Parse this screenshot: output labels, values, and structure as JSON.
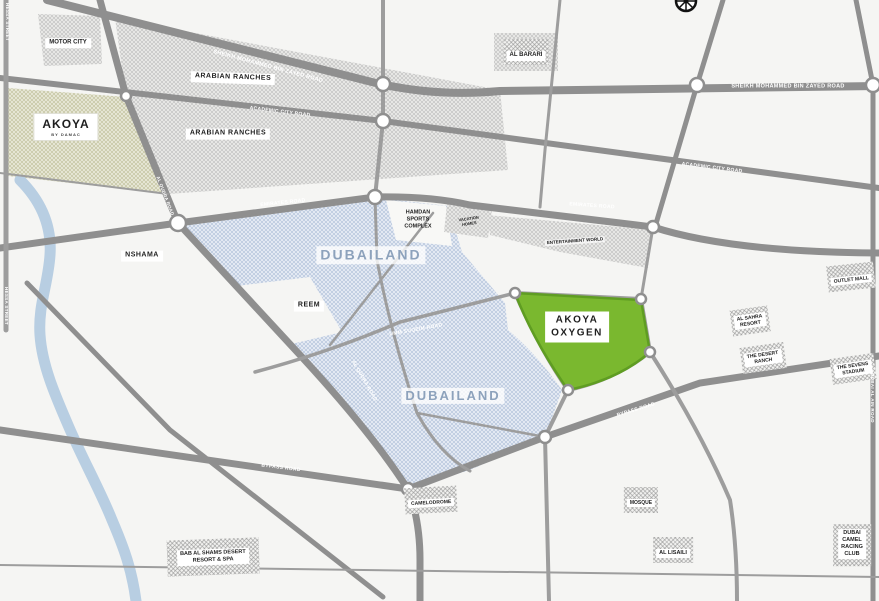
{
  "places": {
    "motor_city": "MOTOR CITY",
    "arabian_ranches": "ARABIAN RANCHES",
    "akoya": {
      "name": "AKOYA",
      "sub": "BY DAMAC"
    },
    "al_barari": "AL BARARI",
    "nshama": "NSHAMA",
    "reem": "REEM",
    "dubailand": "DUBAILAND",
    "hamdan_sports_complex": {
      "l1": "HAMDAN",
      "l2": "SPORTS",
      "l3": "COMPLEX"
    },
    "vacation_homes": {
      "l1": "VACATION",
      "l2": "HOMES"
    },
    "entertainment_world": "ENTERTAINMENT WORLD",
    "akoya_oxygen": {
      "l1": "AKOYA",
      "l2": "OXYGEN"
    },
    "outlet_mall": "OUTLET MALL",
    "al_sahra_resort": {
      "l1": "AL SAHRA",
      "l2": "RESORT"
    },
    "desert_ranch": {
      "l1": "THE DESERT",
      "l2": "RANCH"
    },
    "sevens_stadium": {
      "l1": "THE SEVENS",
      "l2": "STADIUM"
    },
    "camelodrome": "CAMELODROME",
    "bab_al_shams": {
      "l1": "BAB AL SHAMS DESERT",
      "l2": "RESORT & SPA"
    },
    "mosque": "MOSQUE",
    "al_lisaili": "AL LISAILI",
    "dubai_camel_racing_club": {
      "l1": "DUBAI",
      "l2": "CAMEL",
      "l3": "RACING",
      "l4": "CLUB"
    }
  },
  "roads": {
    "smbz": "SHEIKH MOHAMMED BIN ZAYED ROAD",
    "academic": "ACADEMIC CITY ROAD",
    "emirates": "EMIRATES ROAD",
    "umm_suqeim": "UMM SUQEIM ROAD",
    "al_qudra": "AL QUDRA ROAD",
    "bypass": "BYPASS ROAD",
    "hessa": "HESSA STREET",
    "al_ain": "DUBAI AL AIN ROAD"
  },
  "colors": {
    "akoya_oxygen_green": "#7ab82f",
    "akoya_oxygen_border": "#5f9d22",
    "dubailand_hatch_blue": "#b5c4db",
    "road_gray": "#8f8f8f",
    "river_blue": "#b8cee2",
    "dubailand_text": "#8da2bc"
  }
}
